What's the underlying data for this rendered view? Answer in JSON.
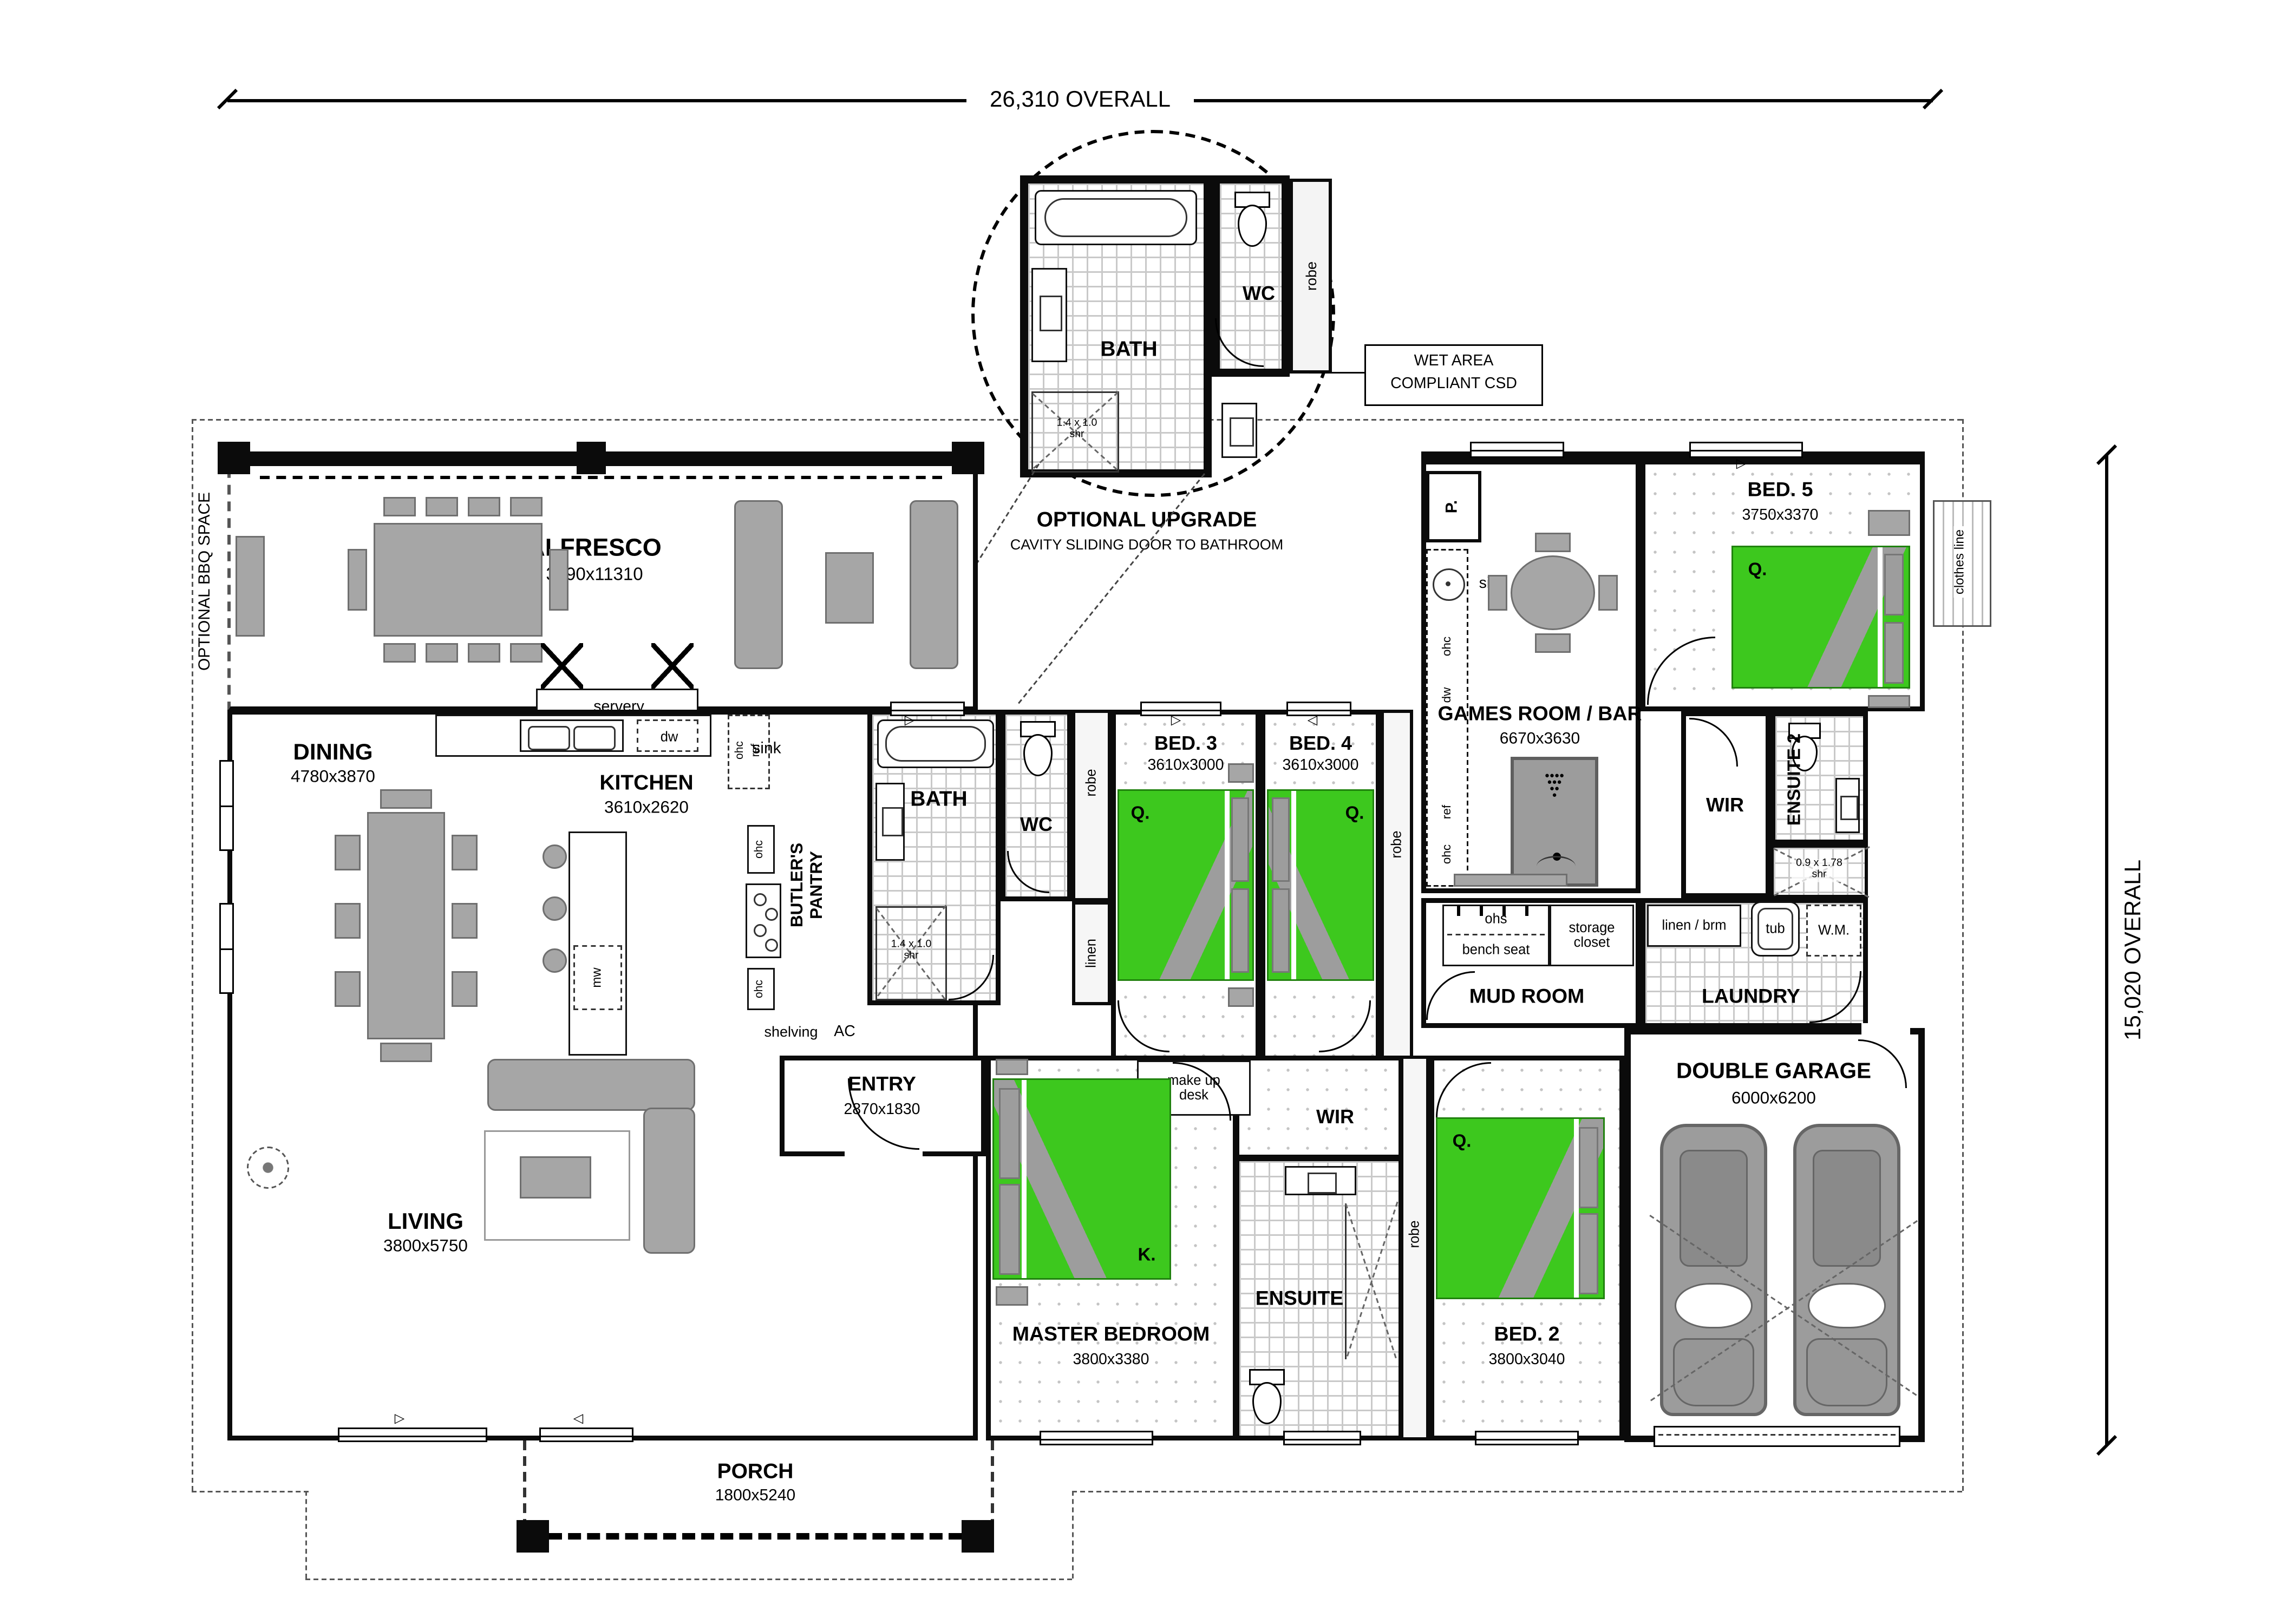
{
  "dimensions": {
    "width": "26,310 OVERALL",
    "height": "15,020 OVERALL"
  },
  "notes": {
    "optional_bbq": "OPTIONAL BBQ SPACE",
    "clothes_line": "clothes line",
    "upgrade_title": "OPTIONAL UPGRADE",
    "upgrade_subtitle": "CAVITY SLIDING DOOR TO BATHROOM",
    "wet_area_1": "WET AREA",
    "wet_area_2": "COMPLIANT CSD"
  },
  "rooms": {
    "alfresco": {
      "name": "ALFRESCO",
      "dims": "3590x11310"
    },
    "dining": {
      "name": "DINING",
      "dims": "4780x3870"
    },
    "kitchen": {
      "name": "KITCHEN",
      "dims": "3610x2620"
    },
    "butlers": {
      "name": "BUTLER'S PANTRY"
    },
    "bath": {
      "name": "BATH"
    },
    "wc": {
      "name": "WC"
    },
    "bed3": {
      "name": "BED. 3",
      "dims": "3610x3000"
    },
    "bed4": {
      "name": "BED. 4",
      "dims": "3610x3000"
    },
    "games": {
      "name": "GAMES ROOM / BAR",
      "dims": "6670x3630"
    },
    "bed5": {
      "name": "BED. 5",
      "dims": "3750x3370"
    },
    "wir2": {
      "name": "WIR"
    },
    "ensuite2": {
      "name": "ENSUITE 2"
    },
    "mudroom": {
      "name": "MUD ROOM"
    },
    "laundry": {
      "name": "LAUNDRY"
    },
    "living": {
      "name": "LIVING",
      "dims": "3800x5750"
    },
    "entry": {
      "name": "ENTRY",
      "dims": "2870x1830"
    },
    "master": {
      "name": "MASTER BEDROOM",
      "dims": "3800x3380"
    },
    "wir": {
      "name": "WIR"
    },
    "ensuite": {
      "name": "ENSUITE"
    },
    "bed2": {
      "name": "BED. 2",
      "dims": "3800x3040"
    },
    "garage": {
      "name": "DOUBLE GARAGE",
      "dims": "6000x6200"
    },
    "porch": {
      "name": "PORCH",
      "dims": "1800x5240"
    }
  },
  "fixtures": {
    "servery": "servery",
    "sink": "sink",
    "dw": "dw",
    "mw": "mw",
    "ohc": "ohc",
    "ref": "ref",
    "ac": "AC",
    "shelving": "shelving",
    "pantry": "P.",
    "tub": "tub",
    "wm": "W.M.",
    "linen_brm": "linen / brm",
    "ohs": "ohs",
    "bench_seat": "bench seat",
    "storage_closet": "storage closet",
    "robe": "robe",
    "linen": "linen",
    "makeup_desk": "make up desk",
    "shower_main": "1.4 x 1.0 shr",
    "shower_ens2": "0.9 x 1.78 shr",
    "queen": "Q.",
    "king": "K."
  },
  "colors": {
    "bed_green": "#3dc81e",
    "furniture_gray": "#a6a6a6",
    "wall_black": "#0b0b0b"
  }
}
